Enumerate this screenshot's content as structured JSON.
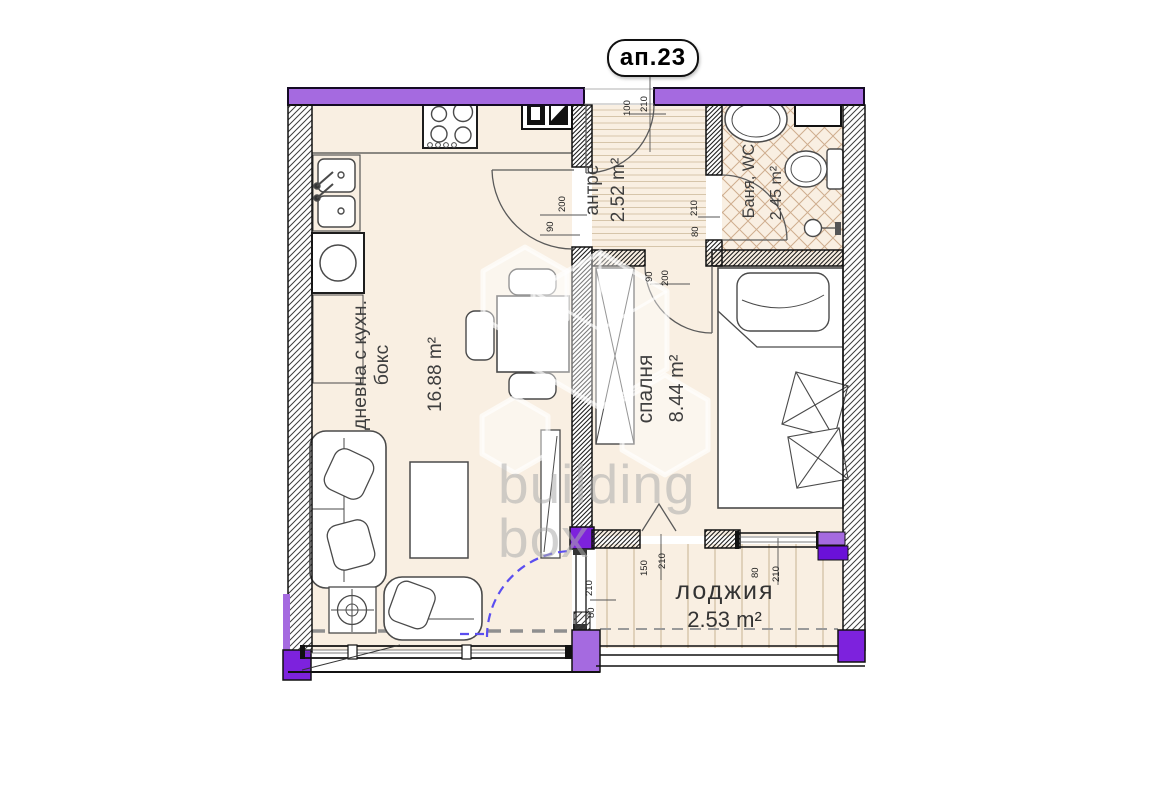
{
  "header": {
    "apartment_label": "ап.23"
  },
  "watermark": {
    "line1": "building",
    "line2": "box"
  },
  "rooms": {
    "living": {
      "name_line1": "дневна с кухн.",
      "name_line2": "бокс",
      "area": "16.88 m²"
    },
    "hall": {
      "name": "антре",
      "area": "2.52 m²"
    },
    "bath": {
      "name": "Баня, WC",
      "area": "2.45 m²"
    },
    "bedroom": {
      "name": "спалня",
      "area": "8.44 m²"
    },
    "loggia": {
      "name": "лоджия",
      "area": "2.53 m²"
    }
  },
  "dims": {
    "entrance": [
      "100",
      "210"
    ],
    "living_door": [
      "200",
      "90"
    ],
    "bath_door": [
      "210",
      "80"
    ],
    "bedroom_door": [
      "90",
      "200"
    ],
    "loggia_door": [
      "150",
      "210"
    ],
    "bedroom_window": [
      "80",
      "210"
    ],
    "living_window": [
      "210",
      "80"
    ]
  },
  "colors": {
    "exterior_wall": "#a56ae0",
    "accent_block": "#7d22dd",
    "room_fill": "#f9efe2",
    "plan_line": "#1a1a1a",
    "proposal_dash": "#5b4ef0"
  }
}
